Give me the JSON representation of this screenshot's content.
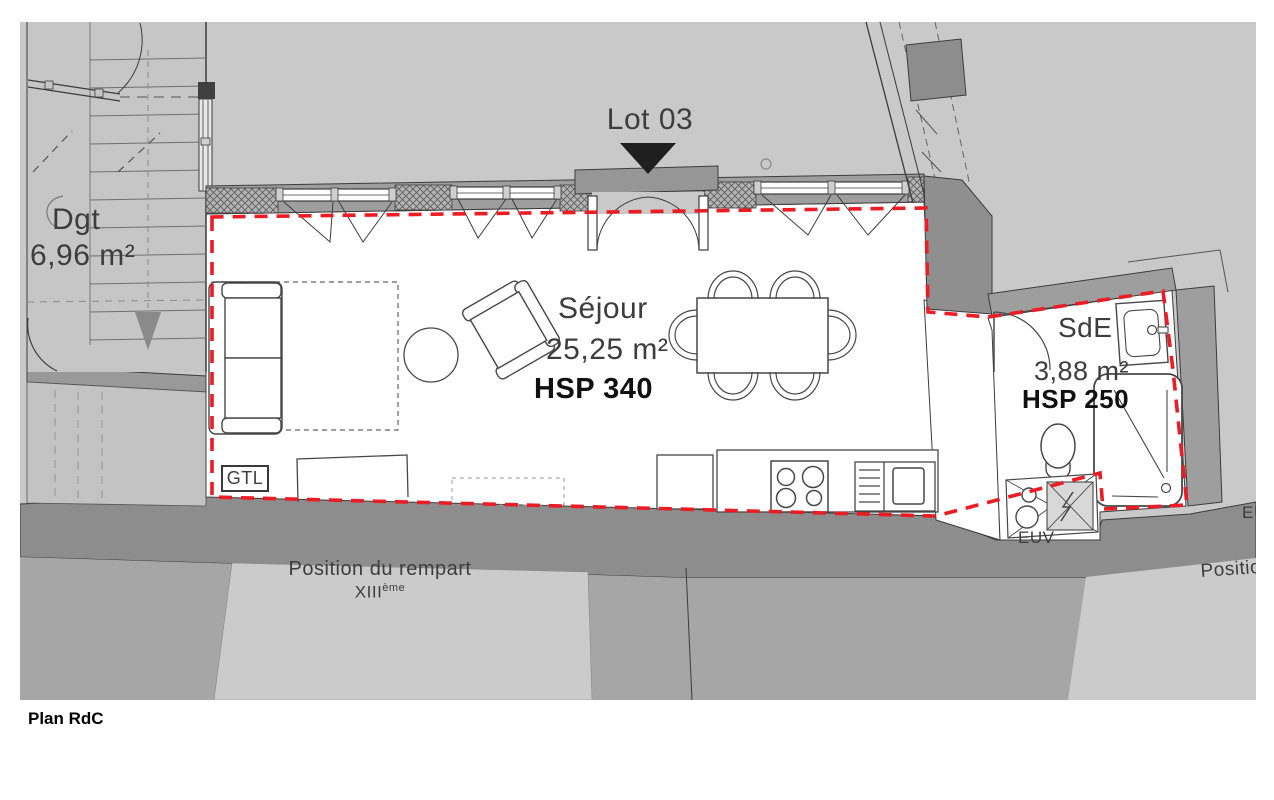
{
  "page": {
    "title": "Plan RdC"
  },
  "plan": {
    "lot": {
      "label": "Lot 03"
    },
    "rooms": {
      "dgt": {
        "name": "Dgt",
        "area": "6,96 m²"
      },
      "sejour": {
        "name": "Séjour",
        "area": "25,25 m²",
        "height": "HSP 340"
      },
      "sde": {
        "name": "SdE",
        "area": "3,88 m²",
        "height": "HSP 250"
      }
    },
    "annotations": {
      "gtl": "GTL",
      "euv": "EUV",
      "euv_edge": "EUV",
      "rampart_line1": "Position du rempart",
      "rampart_line2_base": "XIII",
      "rampart_line2_sup": "ème",
      "rampart_right": "Position du rempart"
    },
    "colors": {
      "lot_boundary": "#ec1c24",
      "canvas_bg": "#c9c9c9",
      "wall": "#8f8f8f",
      "terrain": "#a6a6a6",
      "marker": "#1f1f1f"
    }
  }
}
